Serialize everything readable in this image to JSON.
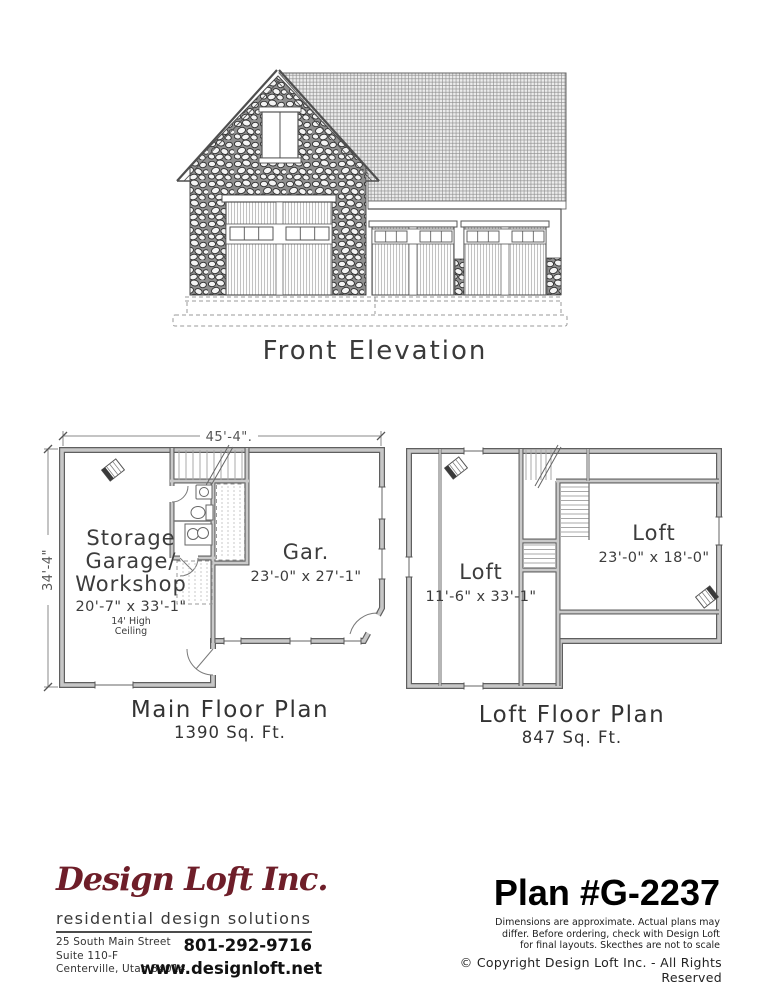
{
  "elevation": {
    "title": "Front Elevation"
  },
  "main_plan": {
    "title": "Main Floor Plan",
    "area": "1390 Sq. Ft.",
    "dim_width": "45'-4\".",
    "dim_height": "34'-4\"",
    "room_storage": {
      "line1": "Storage",
      "line2": "Garage/",
      "line3": "Workshop",
      "size": "20'-7\" x 33'-1\"",
      "note1": "14' High",
      "note2": "Ceiling"
    },
    "room_garage": {
      "name": "Gar.",
      "size": "23'-0\" x 27'-1\""
    }
  },
  "loft_plan": {
    "title": "Loft Floor Plan",
    "area": "847 Sq. Ft.",
    "room_left": {
      "name": "Loft",
      "size": "11'-6\" x 33'-1\""
    },
    "room_right": {
      "name": "Loft",
      "size": "23'-0\" x 18'-0\""
    }
  },
  "footer": {
    "company": "Design Loft Inc.",
    "tagline": "residential design solutions",
    "address1": "25 South Main Street",
    "address2": "Suite 110-F",
    "address3": "Centerville, Utah 84014",
    "phone": "801-292-9716",
    "website": "www.designloft.net",
    "plan_number": "Plan #G-2237",
    "disclaimer1": "Dimensions are approximate.  Actual plans may",
    "disclaimer2": "differ.  Before ordering, check with Design Loft",
    "disclaimer3": "for final layouts.  Skecthes are not to scale",
    "copyright": "© Copyright Design Loft Inc. - All Rights Reserved",
    "brand_color": "#6e1e29"
  }
}
